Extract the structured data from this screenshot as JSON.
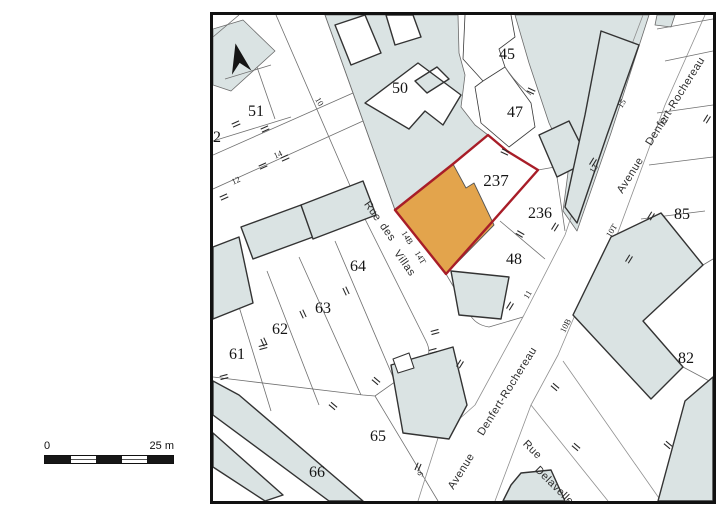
{
  "scale_bar": {
    "left_label": "0",
    "right_label": "25 m"
  },
  "map": {
    "colors": {
      "block_fill": "#dae3e3",
      "building_outline": "#333333",
      "parcel_line": "#5a5a5a",
      "street_edge": "#8f8f8f",
      "highlight_outline": "#a81d28",
      "highlight_fill": "#e3a44c",
      "frame": "#111111"
    },
    "highlight": {
      "parcel_number": "237",
      "outline_color": "#a81d28",
      "building_fill": "#e3a44c"
    },
    "parcel_labels": [
      {
        "text": "45",
        "x": 294,
        "y": 44,
        "size": 16
      },
      {
        "text": "47",
        "x": 302,
        "y": 102,
        "size": 16
      },
      {
        "text": "50",
        "x": 187,
        "y": 78,
        "size": 16
      },
      {
        "text": "51",
        "x": 43,
        "y": 101,
        "size": 16
      },
      {
        "text": "2",
        "x": 4,
        "y": 127,
        "size": 16
      },
      {
        "text": "237",
        "x": 283,
        "y": 171,
        "size": 17
      },
      {
        "text": "236",
        "x": 327,
        "y": 203,
        "size": 16
      },
      {
        "text": "48",
        "x": 301,
        "y": 249,
        "size": 16
      },
      {
        "text": "64",
        "x": 145,
        "y": 256,
        "size": 16
      },
      {
        "text": "63",
        "x": 110,
        "y": 298,
        "size": 16
      },
      {
        "text": "62",
        "x": 67,
        "y": 319,
        "size": 16
      },
      {
        "text": "61",
        "x": 24,
        "y": 344,
        "size": 16
      },
      {
        "text": "66",
        "x": 104,
        "y": 462,
        "size": 16
      },
      {
        "text": "65",
        "x": 165,
        "y": 426,
        "size": 16
      },
      {
        "text": "85",
        "x": 469,
        "y": 204,
        "size": 16
      },
      {
        "text": "82",
        "x": 473,
        "y": 348,
        "size": 16
      }
    ],
    "street_labels": [
      {
        "text": "Rue",
        "x": 157,
        "y": 198,
        "rot": 55
      },
      {
        "text": "des",
        "x": 172,
        "y": 219,
        "rot": 55
      },
      {
        "text": "Villas",
        "x": 189,
        "y": 250,
        "rot": 55
      },
      {
        "text": "Avenue",
        "x": 420,
        "y": 162,
        "rot": -58
      },
      {
        "text": "Denfert-Rochereau",
        "x": 465,
        "y": 88,
        "rot": -58
      },
      {
        "text": "Denfert-Rochereau",
        "x": 297,
        "y": 378,
        "rot": -58
      },
      {
        "text": "Avenue",
        "x": 251,
        "y": 458,
        "rot": -58
      },
      {
        "text": "Rue",
        "x": 317,
        "y": 437,
        "rot": 45
      },
      {
        "text": "Delavelle",
        "x": 339,
        "y": 473,
        "rot": 45
      }
    ],
    "address_labels": [
      {
        "text": "10",
        "x": 104,
        "y": 88,
        "rot": 60
      },
      {
        "text": "14",
        "x": 66,
        "y": 142,
        "rot": -24
      },
      {
        "text": "12",
        "x": 24,
        "y": 168,
        "rot": -24
      },
      {
        "text": "14B",
        "x": 192,
        "y": 224,
        "rot": 58
      },
      {
        "text": "14T",
        "x": 205,
        "y": 244,
        "rot": 58
      },
      {
        "text": "15",
        "x": 411,
        "y": 90,
        "rot": -58
      },
      {
        "text": "12",
        "x": 453,
        "y": 108,
        "rot": -58
      },
      {
        "text": "13",
        "x": 383,
        "y": 155,
        "rot": -58
      },
      {
        "text": "10T",
        "x": 401,
        "y": 217,
        "rot": -58
      },
      {
        "text": "11",
        "x": 317,
        "y": 281,
        "rot": -58
      },
      {
        "text": "10B",
        "x": 355,
        "y": 312,
        "rot": -62
      },
      {
        "text": "9",
        "x": 210,
        "y": 460,
        "rot": -66
      }
    ],
    "ticks": [
      {
        "x": 23,
        "y": 109,
        "rot": -24
      },
      {
        "x": 52,
        "y": 114,
        "rot": -24
      },
      {
        "x": 72,
        "y": 143,
        "rot": -24
      },
      {
        "x": 50,
        "y": 151,
        "rot": -24
      },
      {
        "x": 11,
        "y": 182,
        "rot": -24
      },
      {
        "x": 133,
        "y": 276,
        "rot": 65
      },
      {
        "x": 90,
        "y": 299,
        "rot": 65
      },
      {
        "x": 51,
        "y": 327,
        "rot": 65
      },
      {
        "x": 120,
        "y": 391,
        "rot": 40
      },
      {
        "x": 163,
        "y": 366,
        "rot": 40
      },
      {
        "x": 50,
        "y": 332,
        "rot": -15
      },
      {
        "x": 11,
        "y": 362,
        "rot": -15
      },
      {
        "x": 292,
        "y": 137,
        "rot": 25
      },
      {
        "x": 318,
        "y": 76,
        "rot": 25
      },
      {
        "x": 307,
        "y": 219,
        "rot": 30
      },
      {
        "x": 297,
        "y": 291,
        "rot": -58
      },
      {
        "x": 222,
        "y": 317,
        "rot": -15
      },
      {
        "x": 220,
        "y": 336,
        "rot": -15
      },
      {
        "x": 380,
        "y": 147,
        "rot": -58
      },
      {
        "x": 438,
        "y": 201,
        "rot": -58
      },
      {
        "x": 416,
        "y": 244,
        "rot": -58
      },
      {
        "x": 494,
        "y": 104,
        "rot": -58
      },
      {
        "x": 342,
        "y": 212,
        "rot": -58
      },
      {
        "x": 247,
        "y": 349,
        "rot": -58
      },
      {
        "x": 342,
        "y": 372,
        "rot": 40
      },
      {
        "x": 363,
        "y": 432,
        "rot": 40
      },
      {
        "x": 455,
        "y": 430,
        "rot": 40
      },
      {
        "x": 205,
        "y": 452,
        "rot": -66
      }
    ]
  }
}
